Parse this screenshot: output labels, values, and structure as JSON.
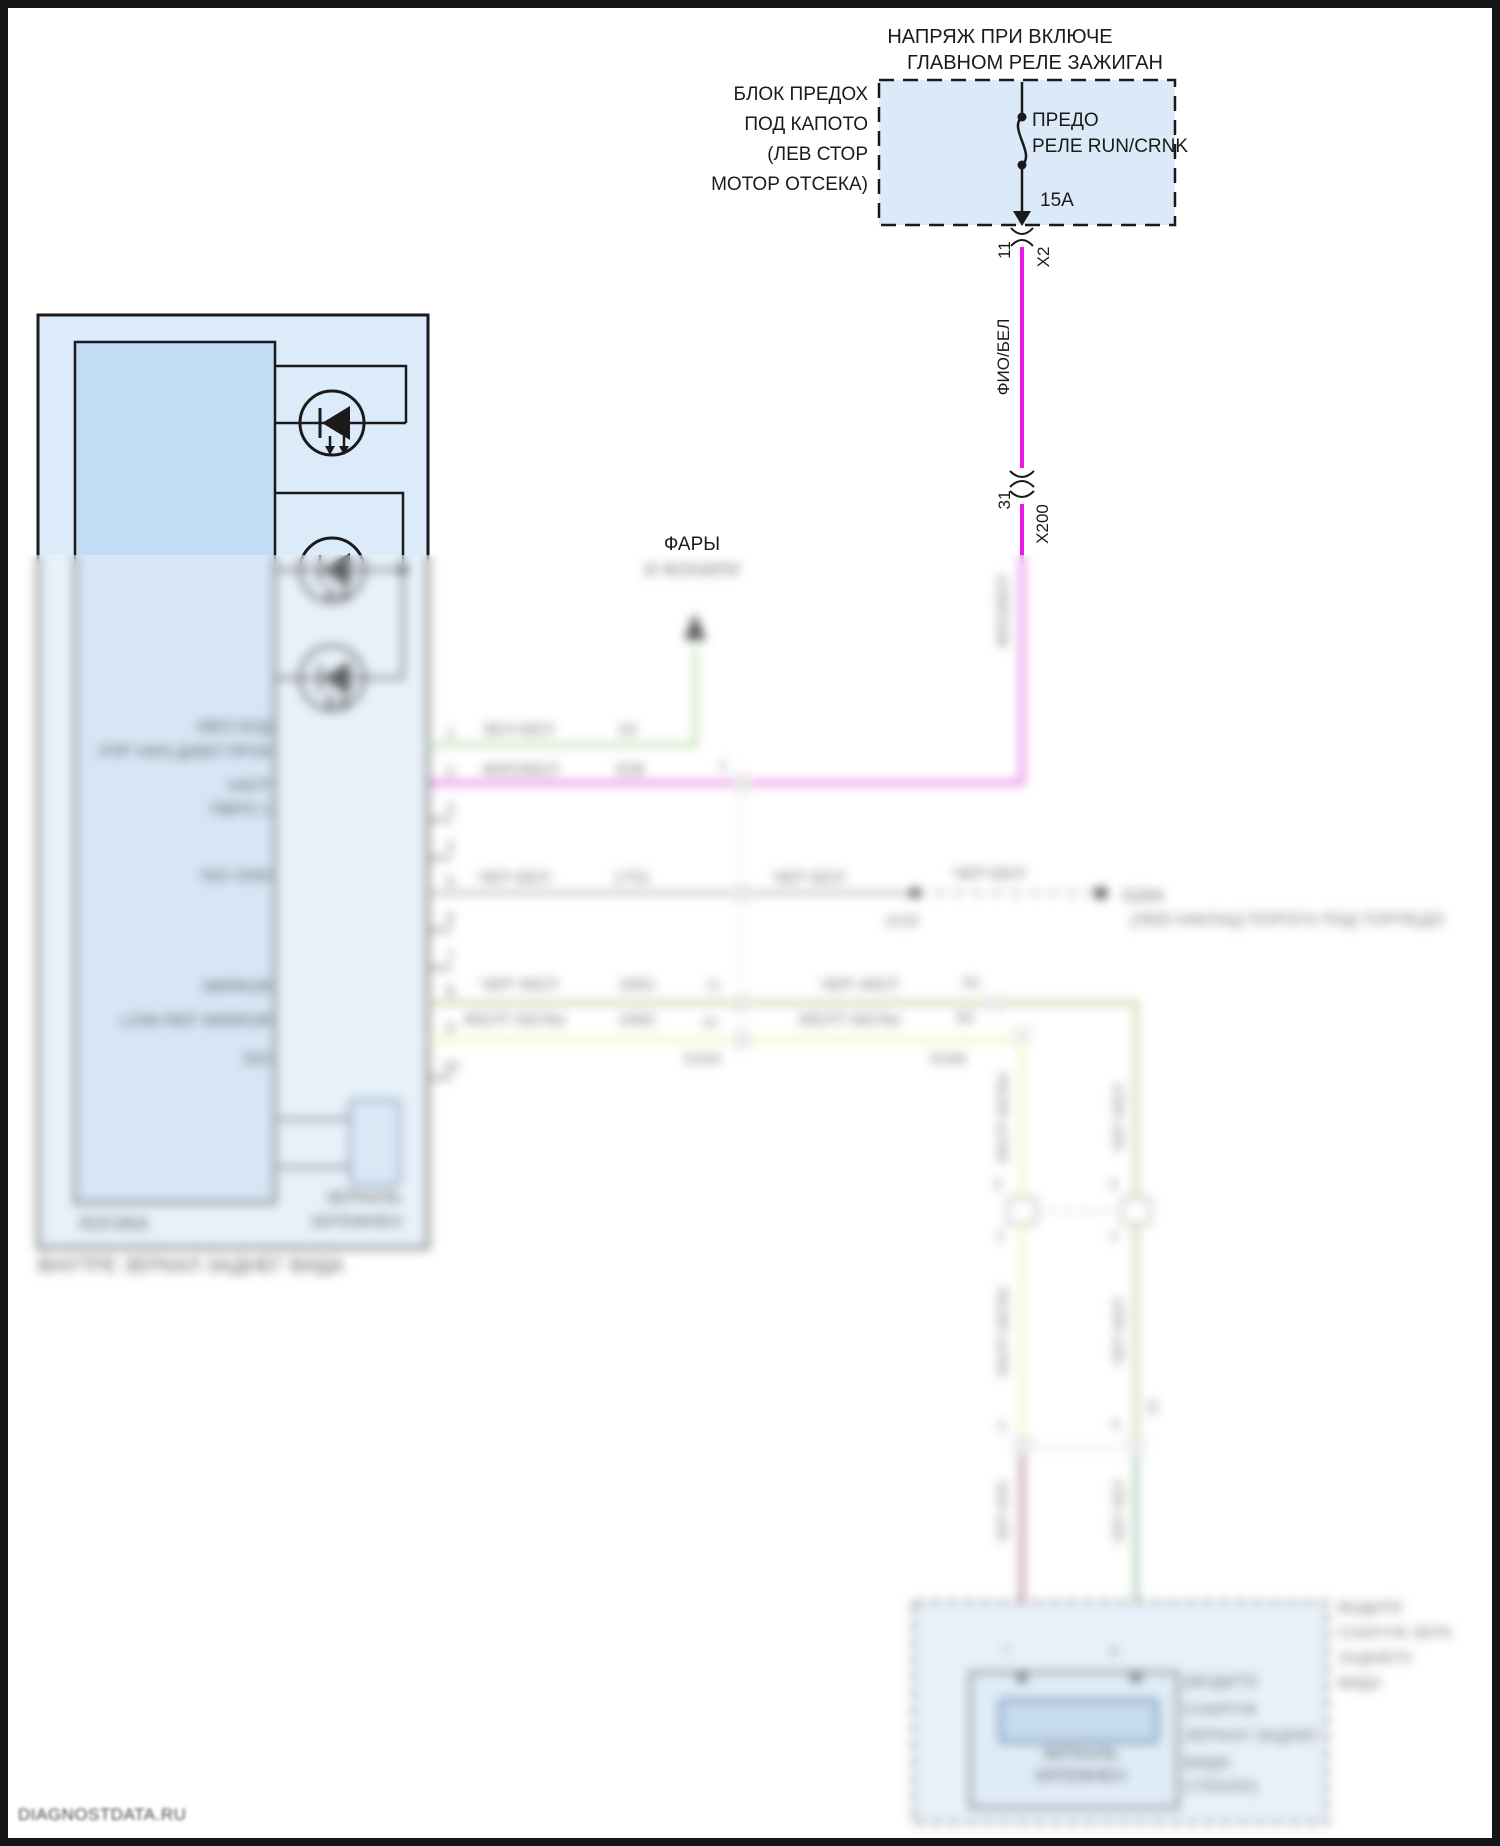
{
  "colors": {
    "magenta": "#ea1bea",
    "green": "#8ed47e",
    "grey": "#9a9a9a",
    "olive": "#b9b96e",
    "yellow": "#f0ef85",
    "dark_red": "#9b4a55",
    "bottom_green": "#79a879",
    "box_fill": "#dcebfa",
    "box_fill_dark": "#c2dcf5",
    "element_fill": "#a9ccf0"
  },
  "header": {
    "line1": "НАПРЯЖ ПРИ ВКЛЮЧЕ",
    "line2": "ГЛАВНОМ РЕЛЕ ЗАЖИГАН"
  },
  "fuse_block": {
    "label1": "БЛОК ПРЕДОХ",
    "label2": "ПОД КАПОТО",
    "label3": "(ЛЕВ СТОР",
    "label4": "МОТОР ОТСЕКА)",
    "fuse1": "ПРЕДО",
    "fuse2": "РЕЛЕ RUN/CRNK",
    "rating": "15A"
  },
  "x2": {
    "pin": "11",
    "name": "X2"
  },
  "x200": {
    "pin": "31",
    "name": "X200"
  },
  "trunk_wire": {
    "label": "ФИО/БЕЛ",
    "label_below": "ФИО/БЕЛ"
  },
  "headlamps": {
    "line1": "ФАРЫ",
    "line2": "И ФОНАРИ"
  },
  "mirror": {
    "caption": "ВНУТРЕ ЗЕРКАЛ ЗАДНЕГ ВИДА",
    "logic_label": "ЛОГИКА",
    "dim_label1": "ЗЕРКАЛЬ",
    "dim_label2": "ЗАТЕМНЕН",
    "pins": [
      {
        "n": "1",
        "label": "МЕЗ КОД",
        "wire": "ЗЕЛ-БЕЛ",
        "circuit": "24"
      },
      {
        "n": "2",
        "label": "УПР НИЗ ДАВЛ ПРОК",
        "wire": "ФИО/БЕЛ",
        "circuit": "639"
      },
      {
        "n": "3",
        "label": "НАГР",
        "wire": "",
        "circuit": ""
      },
      {
        "n": "4",
        "label": "ПВРО 1",
        "wire": "",
        "circuit": ""
      },
      {
        "n": "5",
        "label": "SIG GND",
        "wire": "ЧЕР-БЕЛ",
        "circuit": "1751"
      },
      {
        "n": "6",
        "label": "",
        "wire": "",
        "circuit": ""
      },
      {
        "n": "7",
        "label": "",
        "wire": "",
        "circuit": ""
      },
      {
        "n": "8",
        "label": "MIRROR",
        "wire": "ЧЕР-ЖЕЛ",
        "circuit": "1691"
      },
      {
        "n": "9",
        "label": "LOW REF MIRROR",
        "wire": "ЖЕЛТ-БЕЛЫ",
        "circuit": "1692"
      },
      {
        "n": "10",
        "label": "SIG",
        "wire": "",
        "circuit": ""
      }
    ]
  },
  "x204": {
    "name": "X204",
    "pin2": "2",
    "pin8": "11",
    "pin9": "10",
    "wire5_after": "ЧЕР-БЕЛ",
    "wire8_after": "ЧЕР-ЖЕЛ",
    "wire9_after": "ЖЕЛТ-БЕЛЫ",
    "circuit8_after": "61",
    "circuit9_after": "60"
  },
  "x206": {
    "name": "X206"
  },
  "ground": {
    "splice": "J216",
    "name": "G204",
    "wire": "ЧЕР-БЕЛ",
    "location": "(ЛЕВ НАКЛАД ПОРОГА ПОД ТОРПЕДО"
  },
  "vertical_wires": {
    "yellow_label": "ЖЕЛТ-БЕЛЫ",
    "olive_label": "ЧЕР-ЖЕЛ",
    "red_label": "ЧЕР-КРА",
    "green_label": "ЧЕР-ЗЕЛ",
    "conn_pin_a": "5",
    "conn_pin_b": "3",
    "conn_pin_c": "6",
    "conn_pin_d": "2",
    "conn_pin_e": "16"
  },
  "outside_mirror": {
    "pin_left": "7",
    "pin_right": "8",
    "element1": "ЗЕРКАЛЬ",
    "element2": "ЗАТЕМНЕН",
    "note1": "(ВОДИТЕ",
    "note2": "СНАРУЖ",
    "note3": "ЗЕРКАЛ ЗАДНЕГ",
    "note4": "ВИДА",
    "note5": "СТЕКЛО)",
    "outer1": "ВОДИТЕ",
    "outer2": "СНАРУЖ ЗЕРК",
    "outer3": "ЗАДНЕГО",
    "outer4": "ВИДА"
  },
  "watermark": "DIAGNOSTDATA.RU"
}
